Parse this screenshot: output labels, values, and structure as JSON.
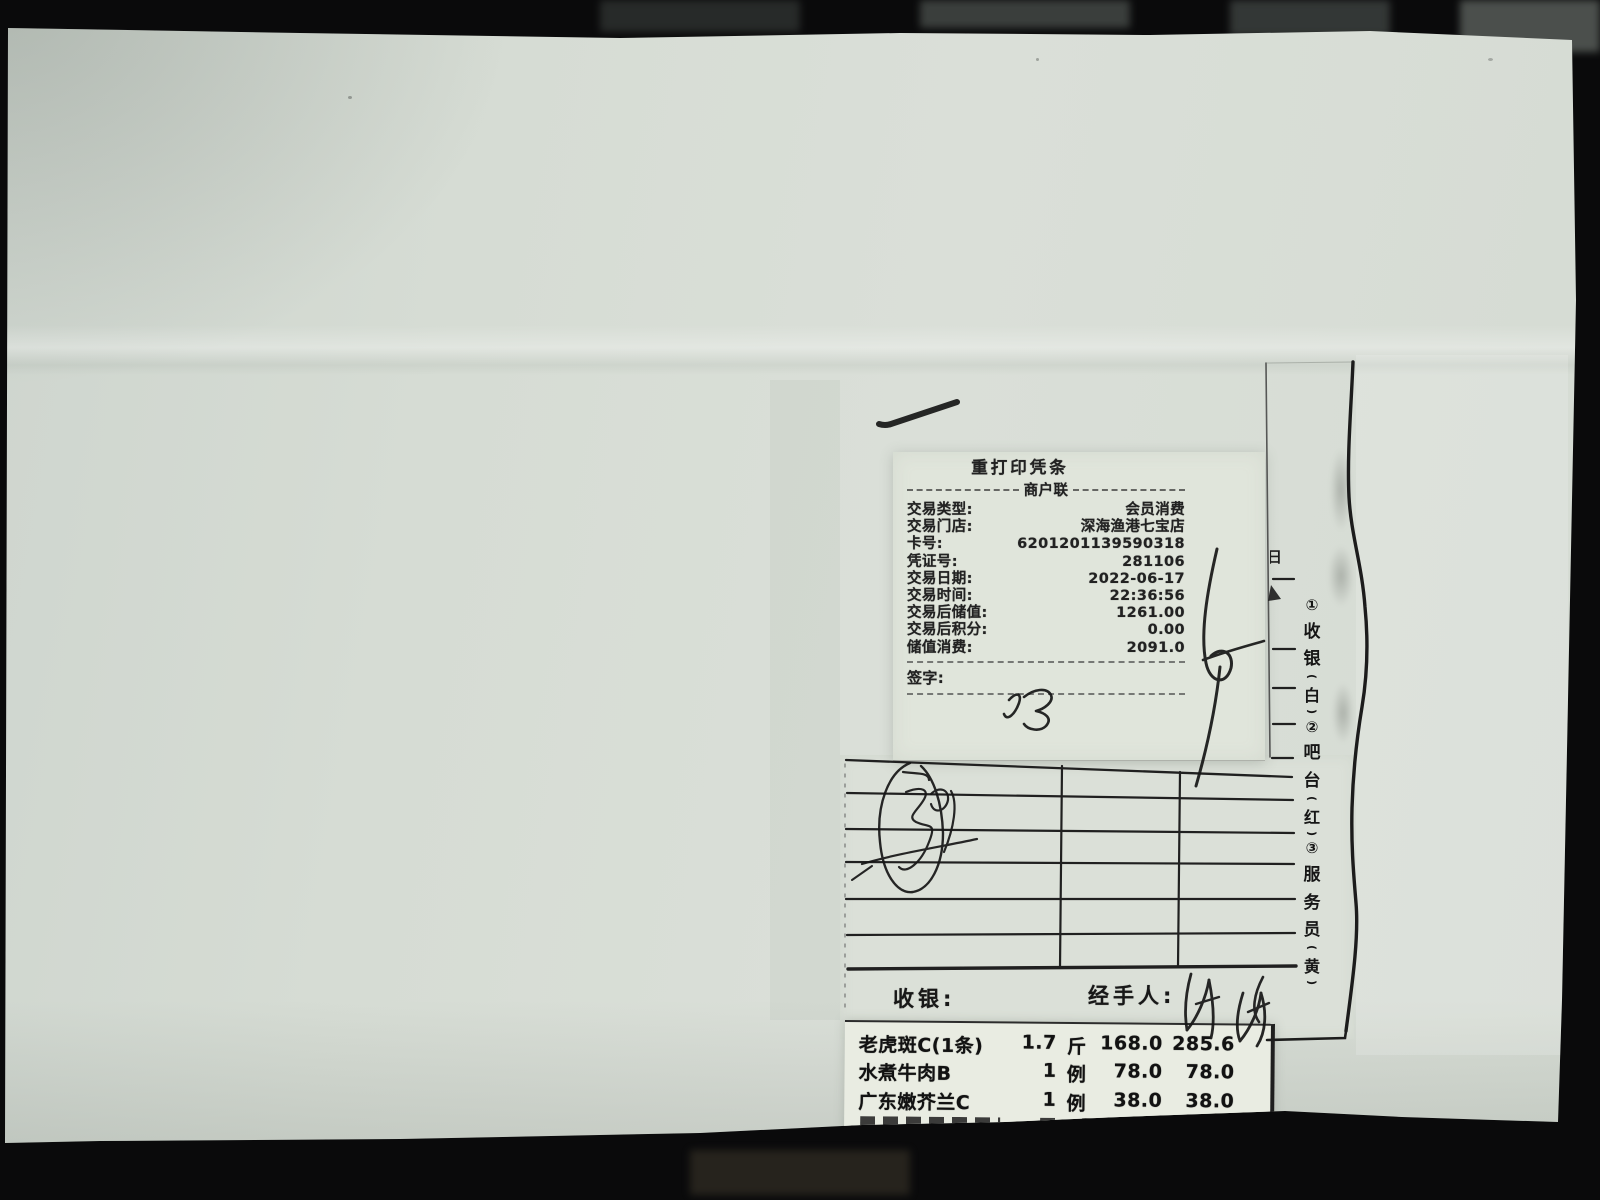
{
  "receipt_slip": {
    "title": "重打印凭条",
    "subtitle": "商户联",
    "rows": [
      {
        "label": "交易类型:",
        "value": "会员消费"
      },
      {
        "label": "交易门店:",
        "value": "深海渔港七宝店"
      },
      {
        "label": "卡号:",
        "value": "6201201139590318"
      },
      {
        "label": "凭证号:",
        "value": "281106"
      },
      {
        "label": "交易日期:",
        "value": "2022-06-17"
      },
      {
        "label": "交易时间:",
        "value": "22:36:56"
      },
      {
        "label": "交易后储值:",
        "value": "1261.00"
      },
      {
        "label": "交易后积分:",
        "value": "0.00"
      },
      {
        "label": "储值消费:",
        "value": "2091.0"
      }
    ],
    "signature_label": "签字:",
    "signature_handwritten": "倪"
  },
  "form_box": {
    "cashier_label": "收银:",
    "handler_label": "经手人:"
  },
  "copy_labels": {
    "open": "(",
    "close": ")",
    "seq": [
      {
        "t": "①"
      },
      {
        "t": "收"
      },
      {
        "t": "银"
      },
      {
        "t": "白"
      },
      {
        "t": "②"
      },
      {
        "t": "吧"
      },
      {
        "t": "台"
      },
      {
        "t": "红"
      },
      {
        "t": "③"
      },
      {
        "t": "服"
      },
      {
        "t": "务"
      },
      {
        "t": "员"
      },
      {
        "t": "黄"
      }
    ]
  },
  "fragment": {
    "partial_char": "日"
  },
  "items": {
    "rows": [
      {
        "name": "老虎斑C(1条)",
        "qty": "1.7",
        "unit": "斤",
        "price": "168.0",
        "amount": "285.6"
      },
      {
        "name": "水煮牛肉B",
        "qty": "1",
        "unit": "例",
        "price": "78.0",
        "amount": "78.0"
      },
      {
        "name": "广东嫩芥兰C",
        "qty": "1",
        "unit": "例",
        "price": "38.0",
        "amount": "38.0"
      }
    ]
  },
  "colors": {
    "paper": "#d6dcd4",
    "ink": "#1d1d1d",
    "strip": "#e9ece2",
    "background": "#0a0a0b"
  }
}
